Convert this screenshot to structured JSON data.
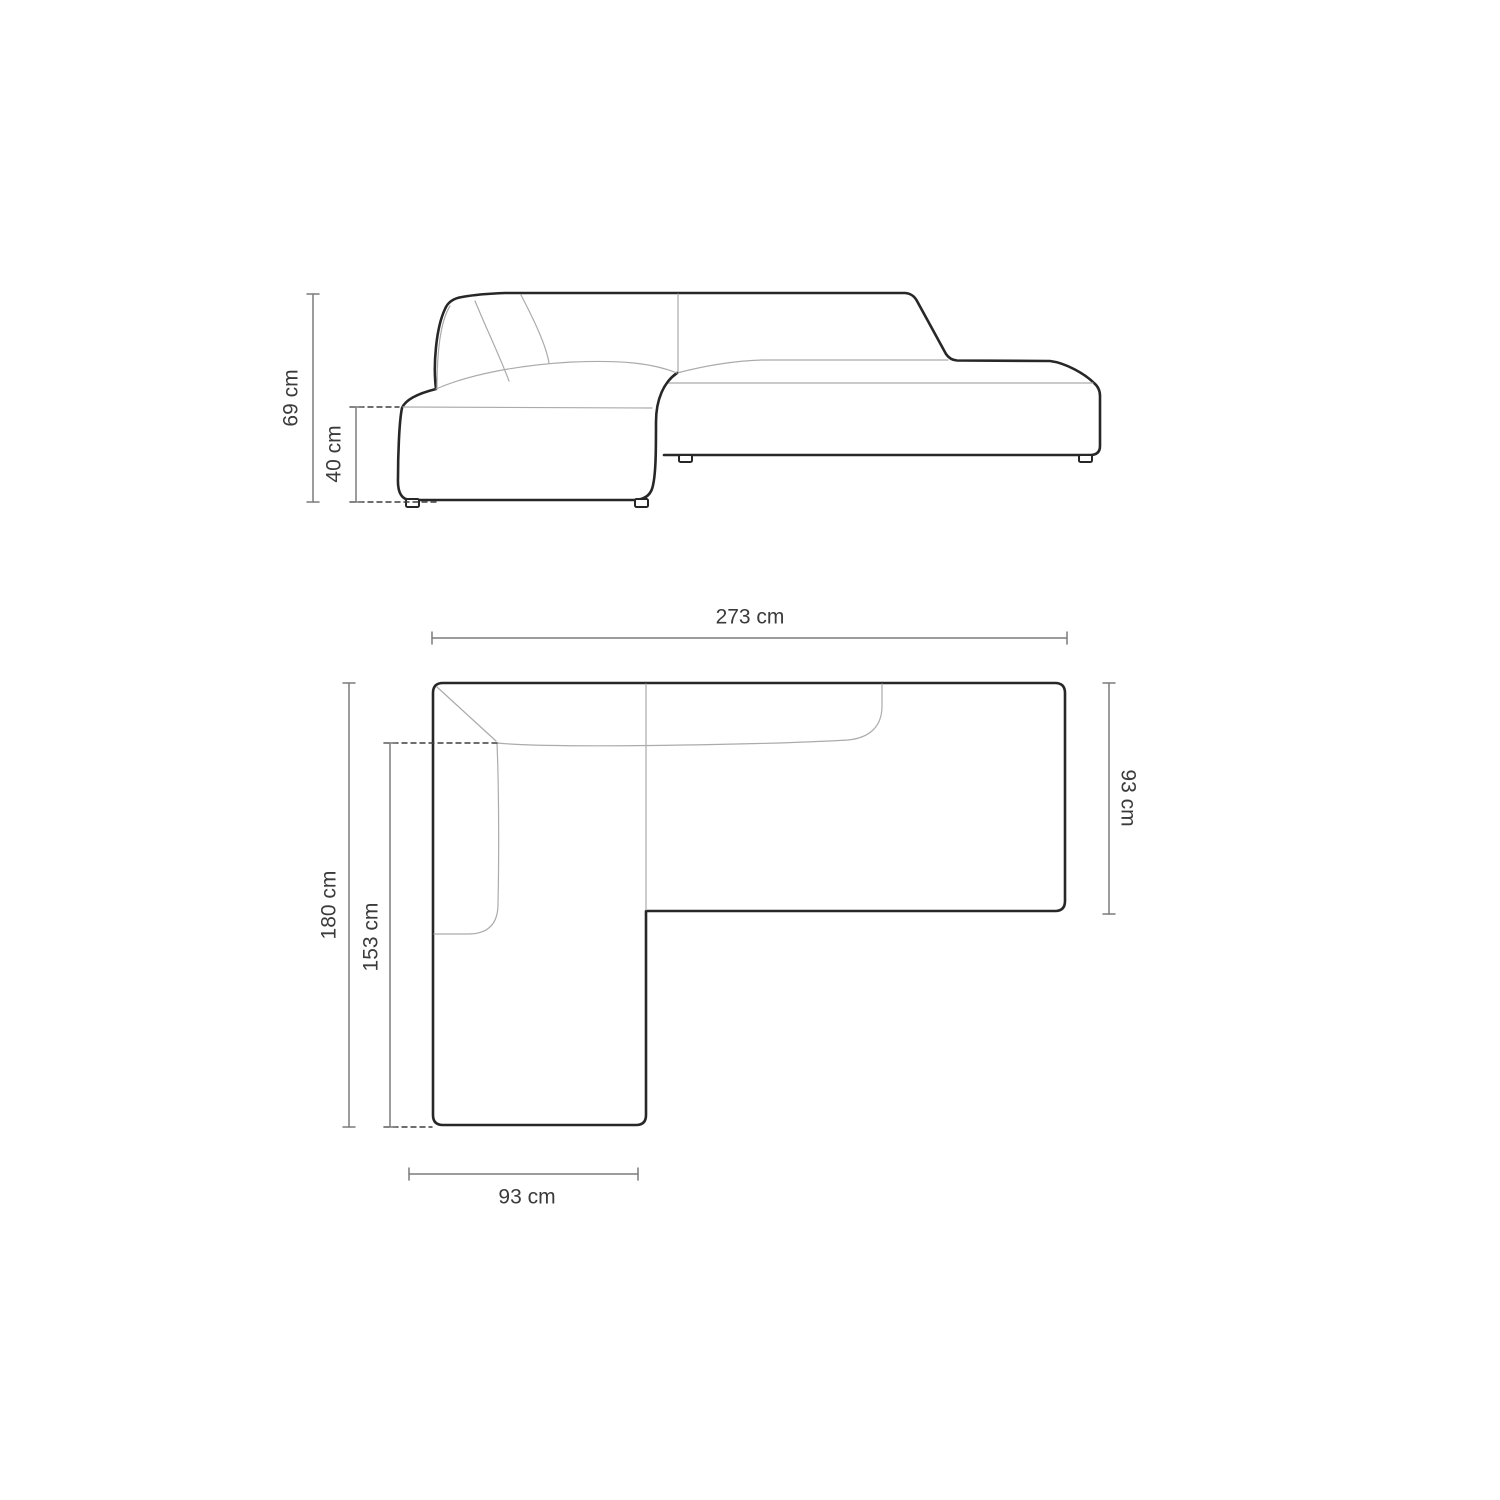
{
  "colors": {
    "background": "#ffffff",
    "outline": "#272727",
    "seam_line": "#ababab",
    "dimension_line": "#7c7c7c",
    "dashed_line": "#3f3f3f",
    "label_text": "#3b3b3b"
  },
  "views": {
    "elevation": {
      "dimensions": {
        "total_height": {
          "label": "69 cm"
        },
        "seat_height": {
          "label": "40 cm"
        }
      }
    },
    "plan": {
      "dimensions": {
        "total_width": {
          "label": "273 cm"
        },
        "total_depth": {
          "label": "180 cm"
        },
        "chaise_depth": {
          "label": "153 cm"
        },
        "body_depth": {
          "label": "93 cm"
        },
        "chaise_width": {
          "label": "93 cm"
        }
      }
    }
  }
}
